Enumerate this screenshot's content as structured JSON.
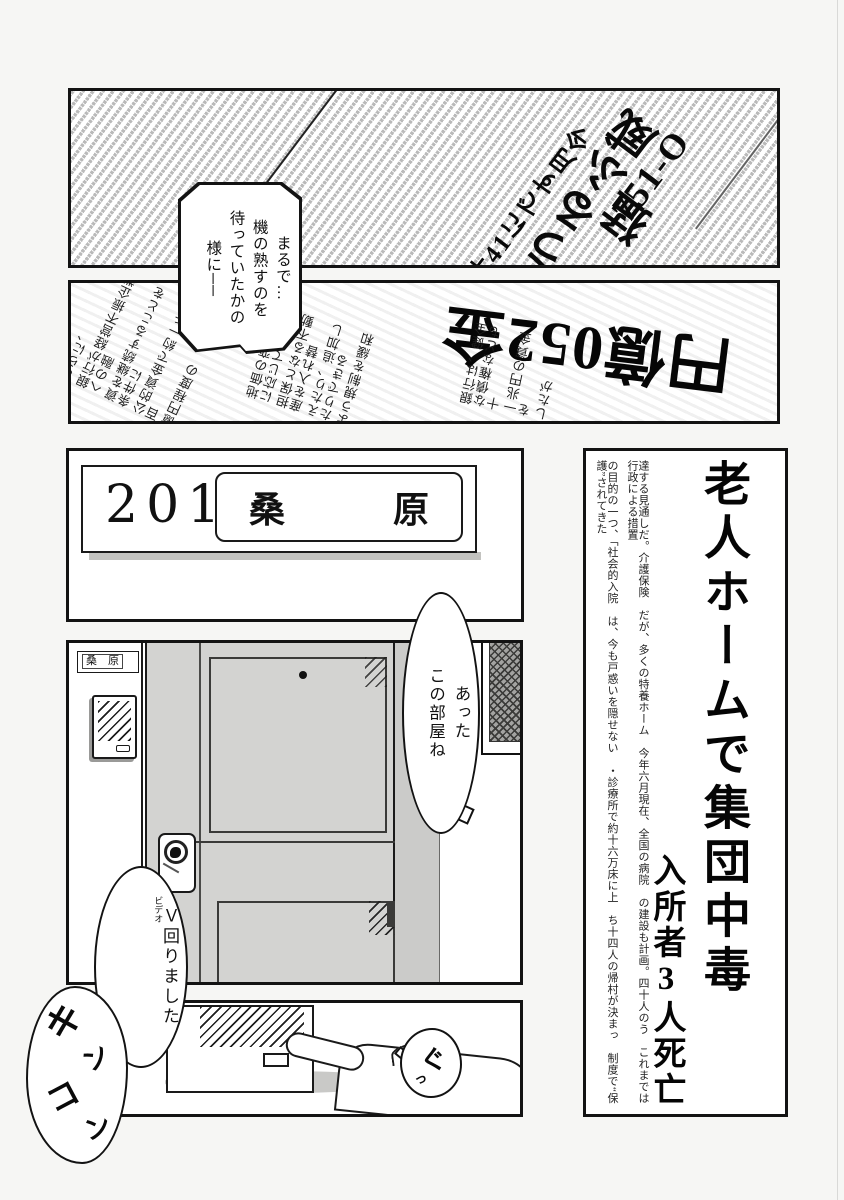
{
  "panel1_newspaper": {
    "headline_o157": "O-157",
    "headline_rage": "猛威ふるう",
    "headline_month": "今月すでに14件",
    "narration_bubble": "まるで…\n機の熟すのを\n待っていたかの\n様に──"
  },
  "panel2_newspaper": {
    "headline": "金250億円",
    "column_block_a": {
      "c1": "さらに、",
      "c2": "銀行が経営不振企業への融",
      "c3": "資を継続することを条件に",
      "c4": "公的資金で約一千五百",
      "c5": "億円程度の"
    },
    "column_block_b": {
      "c1": "地価の変動などに応じて",
      "c2": "担保となる不動産を入れ替",
      "c3": "えたり、追加したりできる",
      "c4": "よう規制を緩和"
    },
    "column_block_c": {
      "c1": "銀行は、健全な債権なども十",
      "c2": "一兆円の資金を",
      "c3": "したが"
    }
  },
  "panel3_nameplate": {
    "room_number": "201",
    "resident_name": "桑　　　原"
  },
  "panel4_article": {
    "headline_main": "老人ホームで集団中毒",
    "headline_sub": "入所者3人死亡",
    "body_col_right": "達する見通しだ。介護保険　だが、多くの特養ホーム　今年六月現在、全国の病院　の建設も計画。四十人のう　これまでは行政による措置",
    "body_col_left": "の目的の一つ、「社会的入院　は、今も戸惑いを隠せない　・診療所で約十六万床に上　ち十四人の帰村が決まっ　制度で“保護”されてきた"
  },
  "panel5_door": {
    "door_plate_name": "桑　原",
    "bubble_found": "あった\nこの部屋ね"
  },
  "panel6_doorbell": {
    "bubble_video_main": "Ｖ回りました",
    "bubble_video_furigana": "ビデオ",
    "sfx_doorbell": {
      "k1": "キ",
      "k2": "ン",
      "k3": "コ",
      "k4": "ン"
    },
    "sfx_press_main": "ぐ",
    "sfx_press_small": "っ"
  }
}
